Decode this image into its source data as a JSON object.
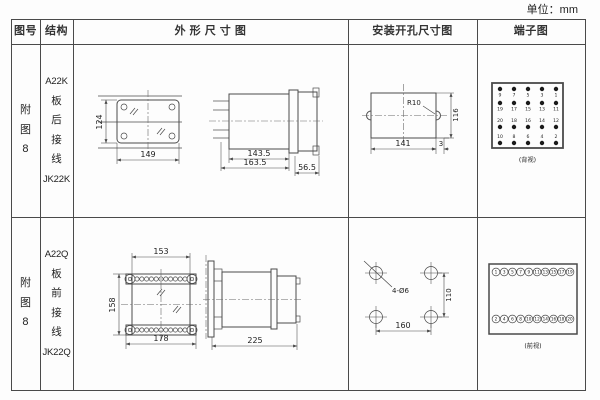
{
  "page": {
    "unit_label": "单位：mm"
  },
  "table": {
    "headers": {
      "fig_no": "图号",
      "structure": "结构",
      "outline": "外 形 尺 寸 图",
      "mounting": "安装开孔尺寸图",
      "terminal": "端子图"
    }
  },
  "rows": [
    {
      "fig_no": "附图8",
      "model": "A22K",
      "wiring": "板后接线",
      "relay": "JK22K",
      "outline": {
        "height": "124",
        "width": "149",
        "body_depth": "143.5",
        "total_depth": "163.5",
        "rear_depth": "56.5"
      },
      "mounting": {
        "radius": "R10",
        "cut_width": "141",
        "cut_height": "116",
        "offset": "3"
      },
      "terminal": {
        "caption": "(背视)",
        "grid": [
          [
            "9",
            "7",
            "5",
            "3",
            "1"
          ],
          [
            "19",
            "17",
            "15",
            "13",
            "11"
          ],
          [
            "20",
            "18",
            "16",
            "14",
            "12"
          ],
          [
            "10",
            "8",
            "6",
            "4",
            "2"
          ]
        ]
      }
    },
    {
      "fig_no": "附图8",
      "model": "A22Q",
      "wiring": "板前接线",
      "relay": "JK22Q",
      "outline": {
        "top_width": "153",
        "height": "158",
        "bottom_width": "178",
        "depth": "225"
      },
      "mounting": {
        "hole_label": "4-Ø6",
        "vertical_spacing": "110",
        "horizontal_spacing": "160"
      },
      "terminal": {
        "caption": "(前视)",
        "top": [
          "1",
          "3",
          "5",
          "7",
          "9",
          "11",
          "13",
          "15",
          "17",
          "19"
        ],
        "bottom": [
          "2",
          "4",
          "6",
          "8",
          "10",
          "12",
          "14",
          "16",
          "18",
          "20"
        ]
      }
    }
  ]
}
